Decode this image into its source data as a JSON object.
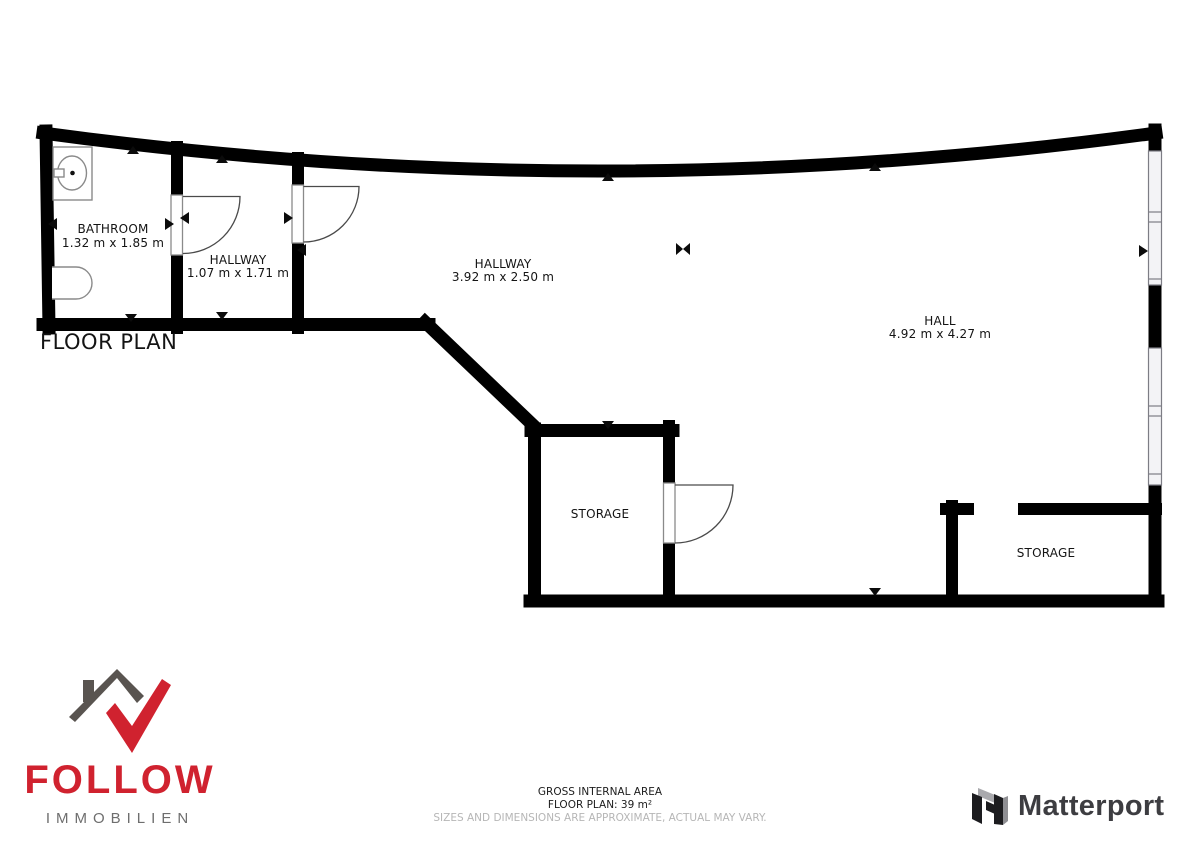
{
  "plan": {
    "title": "FLOOR PLAN",
    "rooms": {
      "bathroom": {
        "name": "BATHROOM",
        "dims": "1.32 m x 1.85 m"
      },
      "hallway_small": {
        "name": "HALLWAY",
        "dims": "1.07 m x 1.71 m"
      },
      "hallway_large": {
        "name": "HALLWAY",
        "dims": "3.92 m x 2.50 m"
      },
      "hall": {
        "name": "HALL",
        "dims": "4.92 m x 4.27 m"
      },
      "storage_left": {
        "name": "STORAGE"
      },
      "storage_right": {
        "name": "STORAGE"
      }
    }
  },
  "footer": {
    "area_title": "GROSS INTERNAL AREA",
    "area_value": "FLOOR PLAN: 39 m²",
    "disclaimer": "SIZES AND DIMENSIONS ARE APPROXIMATE, ACTUAL MAY VARY."
  },
  "branding": {
    "agency_name": "FOLLOW",
    "agency_subtitle": "IMMOBILIEN",
    "agency_red": "#d0222f",
    "agency_gray": "#595450",
    "partner_name": "Matterport",
    "partner_text_color": "#3d3d41"
  },
  "colors": {
    "wall": "#000000",
    "window_outline": "#7d7d85",
    "disclaimer_gray": "#b6b6b6"
  }
}
